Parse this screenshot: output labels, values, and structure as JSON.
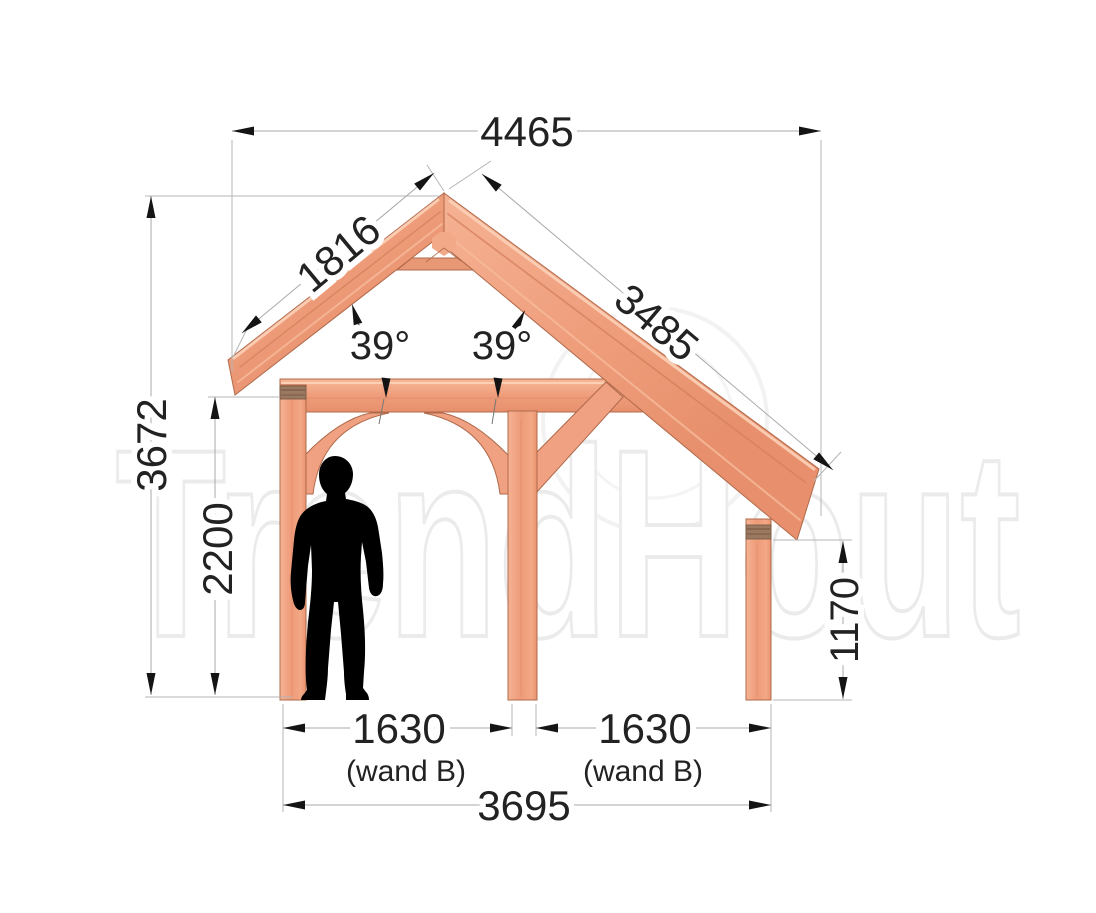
{
  "watermark": {
    "text": "TrendHout"
  },
  "dimensions": {
    "top_width": "4465",
    "left_rafter": "1816",
    "right_rafter": "3485",
    "total_height": "3672",
    "clear_height": "2200",
    "right_height": "1170",
    "bay_left": "1630",
    "bay_left_note": "(wand B)",
    "bay_right": "1630",
    "bay_right_note": "(wand B)",
    "total_width": "3695"
  },
  "angles": {
    "left": "39°",
    "right": "39°"
  },
  "colors": {
    "wood_face": "#f0a180",
    "wood_light": "#f7c0a1",
    "wood_dark": "#d98561",
    "wood_outline": "#b06a4b",
    "plate_brown": "#9b7860",
    "dimension_line": "#a9a9a9",
    "dimension_text": "#222222",
    "silhouette": "#000000",
    "watermark": "#e9e9e9",
    "background": "#ffffff"
  }
}
